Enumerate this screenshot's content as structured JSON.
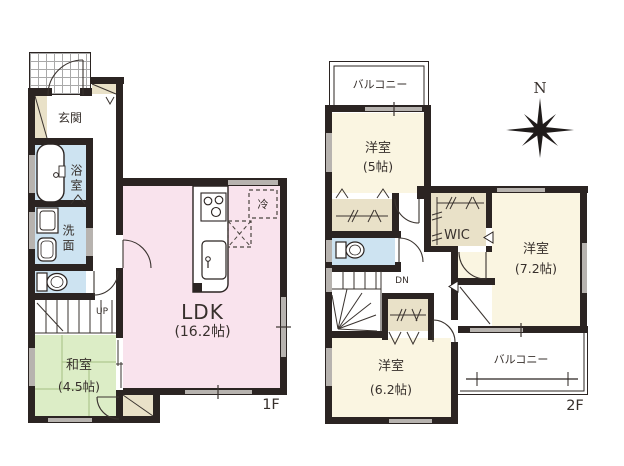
{
  "colors": {
    "wall": "#2b2422",
    "pink": "#f9e3ed",
    "blue": "#cde3f1",
    "green": "#dcedc6",
    "cream": "#faf5e1",
    "beige": "#e9e1c8",
    "win": "#b7b3af",
    "tile": "#a9a9a9",
    "line": "#2b2422"
  },
  "f1": {
    "floor_label": "1F",
    "rooms": {
      "genkan": "玄関",
      "bathroom": "浴室",
      "washroom": "洗面",
      "washitsu": {
        "name": "和室",
        "size": "(4.5帖)"
      },
      "ldk": {
        "name": "LDK",
        "size": "(16.2帖)"
      },
      "stairs": "UP",
      "fridge": "冷"
    }
  },
  "f2": {
    "floor_label": "2F",
    "compass": "N",
    "balcony_top": "バルコニー",
    "balcony_bottom": "バルコニー",
    "rooms": {
      "yoshitsu5": {
        "name": "洋室",
        "size": "(5帖)"
      },
      "yoshitsu72": {
        "name": "洋室",
        "size": "(7.2帖)"
      },
      "yoshitsu62": {
        "name": "洋室",
        "size": "(6.2帖)"
      },
      "wic": "WIC",
      "stairs": "DN"
    }
  }
}
